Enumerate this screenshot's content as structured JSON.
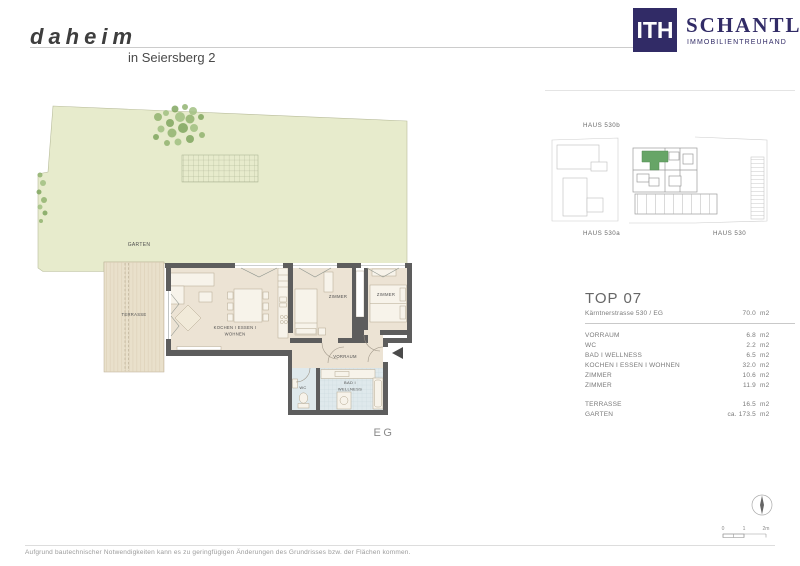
{
  "page": {
    "brand": {
      "logo_text": "daheim",
      "location": "in Seiersberg 2"
    },
    "agency": {
      "monogram": "ITH",
      "name": "SCHANTL",
      "tagline": "IMMOBILIENTREUHAND"
    },
    "disclaimer": "Aufgrund bautechnischer Notwendigkeiten kann es zu geringfügigen Änderungen des Grundrisses bzw. der Flächen kommen."
  },
  "floor_plan": {
    "labels": {
      "garten": "GARTEN",
      "terrasse": "TERRASSE",
      "kitchen_line1": "KOCHEN I ESSEN I",
      "kitchen_line2": "WOHNEN",
      "zimmer_1": "ZIMMER",
      "zimmer_2": "ZIMMER",
      "vorraum": "VORRAUM",
      "wc": "WC",
      "bad_line1": "BAD I",
      "bad_line2": "WELLNESS",
      "level": "EG"
    }
  },
  "site_plan": {
    "haus_530b": "HAUS 530b",
    "haus_530a": "HAUS 530a",
    "haus_530": "HAUS 530"
  },
  "unit_panel": {
    "title": "TOP 07",
    "address": "Kärntnerstrasse 530 / EG",
    "total": {
      "value": "70.0",
      "unit": "m2"
    },
    "rooms": [
      {
        "label": "VORRAUM",
        "value": "6.8",
        "unit": "m2"
      },
      {
        "label": "WC",
        "value": "2.2",
        "unit": "m2"
      },
      {
        "label": "BAD I WELLNESS",
        "value": "6.5",
        "unit": "m2"
      },
      {
        "label": "KOCHEN I ESSEN I WOHNEN",
        "value": "32.0",
        "unit": "m2"
      },
      {
        "label": "ZIMMER",
        "value": "10.6",
        "unit": "m2"
      },
      {
        "label": "ZIMMER",
        "value": "11.9",
        "unit": "m2"
      }
    ],
    "outdoor": [
      {
        "label": "TERRASSE",
        "value": "16.5",
        "unit": "m2"
      },
      {
        "label": "GARTEN",
        "value": "ca. 173.5",
        "unit": "m2"
      }
    ]
  },
  "scale_bar": {
    "ticks": [
      "0",
      "1",
      "2m"
    ]
  },
  "colors": {
    "brand_navy": "#312b66",
    "unit_highlight_green": "#67a567",
    "garden": "#e7ebcc",
    "floor_beige": "#ece3d4",
    "wet_room_blue": "#dfe9ec",
    "wall_gray": "#5d5d5d",
    "terrace": "#e9e0cb"
  }
}
